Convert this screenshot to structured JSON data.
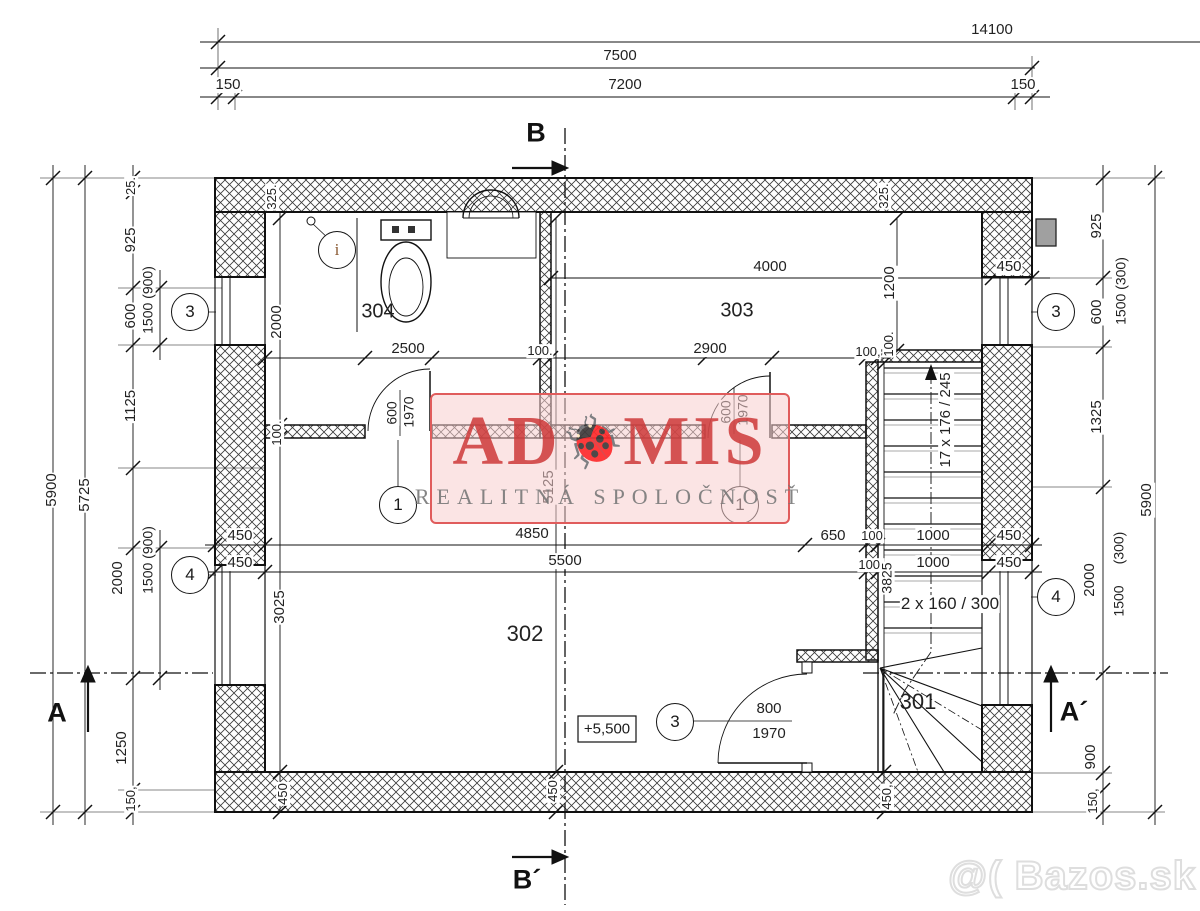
{
  "watermark": {
    "brand_prefix": "AD",
    "brand_suffix": "MIS",
    "ladybug_icon": "🐞",
    "subtitle": "REALITNÁ SPOLOČNOSŤ"
  },
  "photo_watermark": {
    "text": "@( Bazos.sk"
  },
  "level_marker": {
    "text": "+5,500"
  },
  "rooms": [
    {
      "number": "304",
      "x": 378,
      "y": 312,
      "fs": 20
    },
    {
      "number": "303",
      "x": 737,
      "y": 311,
      "fs": 20
    },
    {
      "number": "302",
      "x": 525,
      "y": 634,
      "fs": 22
    },
    {
      "number": "301",
      "x": 918,
      "y": 702,
      "fs": 22
    }
  ],
  "section_markers": [
    {
      "label": "B",
      "x": 536,
      "y": 133
    },
    {
      "label": "B´",
      "x": 527,
      "y": 880
    },
    {
      "label": "A",
      "x": 57,
      "y": 713
    },
    {
      "label": "A´",
      "x": 1074,
      "y": 712
    }
  ],
  "reference_circles": [
    {
      "label": "3",
      "x": 190,
      "y": 312
    },
    {
      "label": "4",
      "x": 190,
      "y": 575
    },
    {
      "label": "3",
      "x": 1056,
      "y": 312
    },
    {
      "label": "4",
      "x": 1056,
      "y": 597
    },
    {
      "label": "1",
      "x": 398,
      "y": 505
    },
    {
      "label": "1",
      "x": 740,
      "y": 505
    },
    {
      "label": "3",
      "x": 675,
      "y": 722
    },
    {
      "label": "i",
      "x": 337,
      "y": 250,
      "variant": "info"
    }
  ],
  "dimensions": [
    {
      "t": "14100",
      "x": 992,
      "y": 30
    },
    {
      "t": "7500",
      "x": 620,
      "y": 56
    },
    {
      "t": "150",
      "x": 228,
      "y": 85
    },
    {
      "t": "7200",
      "x": 625,
      "y": 85
    },
    {
      "t": "150",
      "x": 1023,
      "y": 85
    },
    {
      "t": "25.",
      "x": 131,
      "y": 186,
      "r": -90,
      "fs": 13
    },
    {
      "t": "925",
      "x": 131,
      "y": 240,
      "r": -90
    },
    {
      "t": "600",
      "x": 131,
      "y": 316,
      "r": -90
    },
    {
      "t": "1125",
      "x": 131,
      "y": 406,
      "r": -90
    },
    {
      "t": "2000",
      "x": 118,
      "y": 578,
      "r": -90
    },
    {
      "t": "1250",
      "x": 122,
      "y": 748,
      "r": -90
    },
    {
      "t": "150,",
      "x": 131,
      "y": 799,
      "r": -90,
      "fs": 13
    },
    {
      "t": "1500 (900)",
      "x": 148,
      "y": 300,
      "r": -90,
      "fs": 14
    },
    {
      "t": "1500 (900)",
      "x": 148,
      "y": 560,
      "r": -90,
      "fs": 14
    },
    {
      "t": "5725",
      "x": 85,
      "y": 495,
      "r": -90
    },
    {
      "t": "5900",
      "x": 52,
      "y": 490,
      "r": -90
    },
    {
      "t": "925",
      "x": 1097,
      "y": 226,
      "r": -90
    },
    {
      "t": "600",
      "x": 1097,
      "y": 312,
      "r": -90
    },
    {
      "t": "1325",
      "x": 1097,
      "y": 417,
      "r": -90
    },
    {
      "t": "1500 (300)",
      "x": 1121,
      "y": 291,
      "r": -90,
      "fs": 14
    },
    {
      "t": "2000",
      "x": 1090,
      "y": 580,
      "r": -90
    },
    {
      "t": "(300)",
      "x": 1119,
      "y": 548,
      "r": -90,
      "fs": 14
    },
    {
      "t": "1500",
      "x": 1119,
      "y": 601,
      "r": -90,
      "fs": 14
    },
    {
      "t": "900",
      "x": 1091,
      "y": 757,
      "r": -90
    },
    {
      "t": "150,",
      "x": 1093,
      "y": 801,
      "r": -90,
      "fs": 13
    },
    {
      "t": "5900",
      "x": 1147,
      "y": 500,
      "r": -90
    },
    {
      "t": "325.",
      "x": 272,
      "y": 197,
      "r": -90,
      "fs": 13
    },
    {
      "t": "325.",
      "x": 884,
      "y": 196,
      "r": -90,
      "fs": 13
    },
    {
      "t": "2000",
      "x": 277,
      "y": 322,
      "r": -90
    },
    {
      "t": "100.",
      "x": 277,
      "y": 433,
      "r": -90,
      "fs": 13
    },
    {
      "t": "2500",
      "x": 408,
      "y": 349
    },
    {
      "t": "100.",
      "x": 540,
      "y": 351,
      "fs": 13
    },
    {
      "t": "2900",
      "x": 710,
      "y": 349
    },
    {
      "t": "100,",
      "x": 868,
      "y": 352,
      "fs": 13
    },
    {
      "t": "100.",
      "x": 889,
      "y": 344,
      "r": -90,
      "fs": 13
    },
    {
      "t": "600",
      "x": 392,
      "y": 413,
      "r": -90,
      "fs": 14
    },
    {
      "t": "1970",
      "x": 409,
      "y": 412,
      "r": -90,
      "fs": 14
    },
    {
      "t": "600",
      "x": 726,
      "y": 412,
      "r": -90,
      "fs": 14
    },
    {
      "t": "1970",
      "x": 743,
      "y": 410,
      "r": -90,
      "fs": 14
    },
    {
      "t": "4000",
      "x": 770,
      "y": 267
    },
    {
      "t": "450",
      "x": 1009,
      "y": 267
    },
    {
      "t": "1200",
      "x": 890,
      "y": 283,
      "r": -90
    },
    {
      "t": "450",
      "x": 240,
      "y": 536
    },
    {
      "t": "4850",
      "x": 532,
      "y": 534
    },
    {
      "t": "650",
      "x": 833,
      "y": 536
    },
    {
      "t": "100",
      "x": 872,
      "y": 536,
      "fs": 13
    },
    {
      "t": "1000",
      "x": 933,
      "y": 536
    },
    {
      "t": "450",
      "x": 1009,
      "y": 536
    },
    {
      "t": "450",
      "x": 240,
      "y": 563
    },
    {
      "t": "5500",
      "x": 565,
      "y": 561
    },
    {
      "t": "100,",
      "x": 871,
      "y": 565,
      "fs": 13
    },
    {
      "t": "1000",
      "x": 933,
      "y": 563
    },
    {
      "t": "450",
      "x": 1009,
      "y": 563
    },
    {
      "t": "5125",
      "x": 549,
      "y": 487,
      "r": -90
    },
    {
      "t": "3025",
      "x": 280,
      "y": 607,
      "r": -90
    },
    {
      "t": "3825",
      "x": 887,
      "y": 578,
      "r": -90,
      "fs": 14
    },
    {
      "t": "17  x  176 / 245",
      "x": 946,
      "y": 420,
      "r": -90
    },
    {
      "t": "2 x 160 / 300",
      "x": 950,
      "y": 604,
      "fs": 17
    },
    {
      "t": "800",
      "x": 769,
      "y": 709
    },
    {
      "t": "1970",
      "x": 769,
      "y": 734
    },
    {
      "t": "450",
      "x": 283,
      "y": 794,
      "r": -90,
      "fs": 13
    },
    {
      "t": "450",
      "x": 553,
      "y": 791,
      "r": -90,
      "fs": 13
    },
    {
      "t": "450,",
      "x": 887,
      "y": 797,
      "r": -90,
      "fs": 13
    }
  ]
}
